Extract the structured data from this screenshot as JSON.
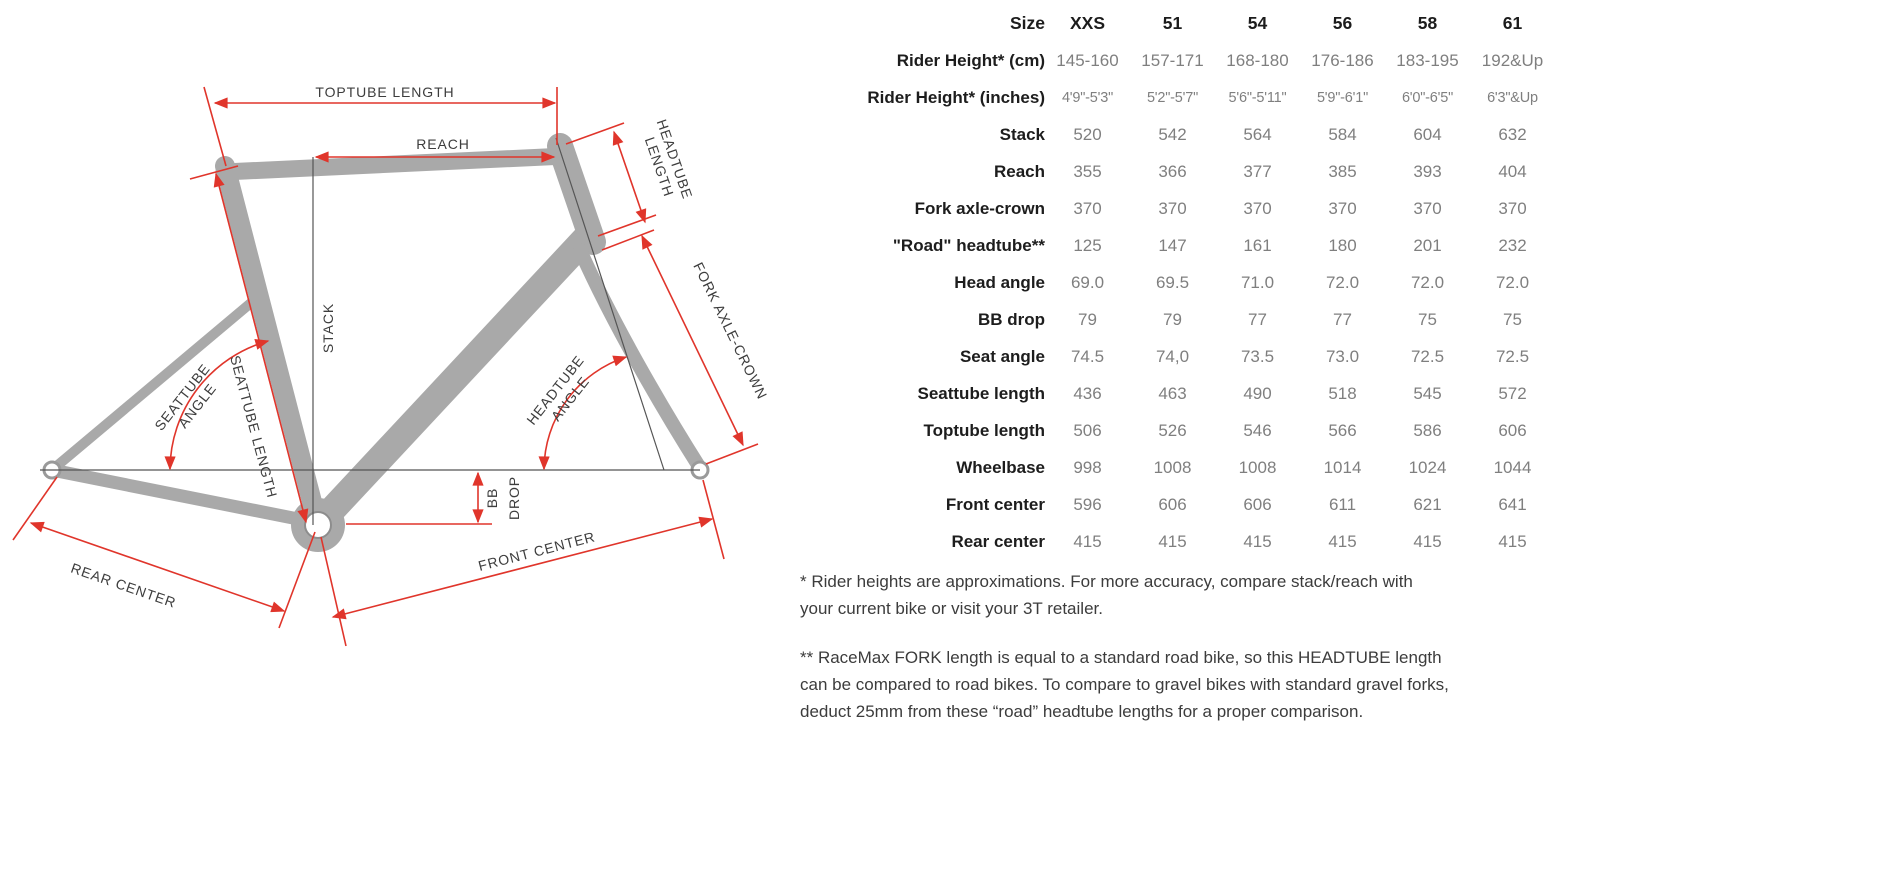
{
  "diagram": {
    "colors": {
      "dimension_red": "#e0352b",
      "frame_gray": "#a9a9a9",
      "reference_dark": "#555555"
    },
    "labels": {
      "toptube": "TOPTUBE LENGTH",
      "reach": "REACH",
      "headtube1": "HEADTUBE",
      "headtube2": "LENGTH",
      "fork": "FORK AXLE-CROWN",
      "stack": "STACK",
      "seattube_angle1": "SEATTUBE",
      "seattube_angle2": "ANGLE",
      "seattube_length": "SEATTUBE LENGTH",
      "headtube_angle1": "HEADTUBE",
      "headtube_angle2": "ANGLE",
      "bb": "BB",
      "drop": "DROP",
      "rear_center": "REAR CENTER",
      "front_center": "FRONT CENTER"
    }
  },
  "table": {
    "header": {
      "label": "Size",
      "values": [
        "XXS",
        "51",
        "54",
        "56",
        "58",
        "61"
      ]
    },
    "rows": [
      {
        "label": "Rider Height* (cm)",
        "values": [
          "145-160",
          "157-171",
          "168-180",
          "176-186",
          "183-195",
          "192&Up"
        ]
      },
      {
        "label": "Rider Height* (inches)",
        "values": [
          "4'9\"-5'3\"",
          "5'2\"-5'7\"",
          "5'6\"-5'11\"",
          "5'9\"-6'1\"",
          "6'0\"-6'5\"",
          "6'3\"&Up"
        ]
      },
      {
        "label": "Stack",
        "values": [
          "520",
          "542",
          "564",
          "584",
          "604",
          "632"
        ]
      },
      {
        "label": "Reach",
        "values": [
          "355",
          "366",
          "377",
          "385",
          "393",
          "404"
        ]
      },
      {
        "label": "Fork axle-crown",
        "values": [
          "370",
          "370",
          "370",
          "370",
          "370",
          "370"
        ]
      },
      {
        "label": "\"Road\" headtube**",
        "values": [
          "125",
          "147",
          "161",
          "180",
          "201",
          "232"
        ]
      },
      {
        "label": "Head angle",
        "values": [
          "69.0",
          "69.5",
          "71.0",
          "72.0",
          "72.0",
          "72.0"
        ]
      },
      {
        "label": "BB drop",
        "values": [
          "79",
          "79",
          "77",
          "77",
          "75",
          "75"
        ]
      },
      {
        "label": "Seat angle",
        "values": [
          "74.5",
          "74,0",
          "73.5",
          "73.0",
          "72.5",
          "72.5"
        ]
      },
      {
        "label": "Seattube length",
        "values": [
          "436",
          "463",
          "490",
          "518",
          "545",
          "572"
        ]
      },
      {
        "label": "Toptube length",
        "values": [
          "506",
          "526",
          "546",
          "566",
          "586",
          "606"
        ]
      },
      {
        "label": "Wheelbase",
        "values": [
          "998",
          "1008",
          "1008",
          "1014",
          "1024",
          "1044"
        ]
      },
      {
        "label": "Front center",
        "values": [
          "596",
          "606",
          "606",
          "611",
          "621",
          "641"
        ]
      },
      {
        "label": "Rear center",
        "values": [
          "415",
          "415",
          "415",
          "415",
          "415",
          "415"
        ]
      }
    ]
  },
  "footnotes": [
    {
      "lines": [
        "* Rider heights are approximations. For more accuracy, compare stack/reach with",
        "your current bike or visit your 3T retailer."
      ]
    },
    {
      "lines": [
        "** RaceMax FORK length is equal to a standard road bike, so this HEADTUBE length",
        "can be compared to road bikes. To compare to gravel bikes with standard gravel forks,",
        "deduct 25mm from these “road” headtube lengths for a proper comparison."
      ]
    }
  ]
}
